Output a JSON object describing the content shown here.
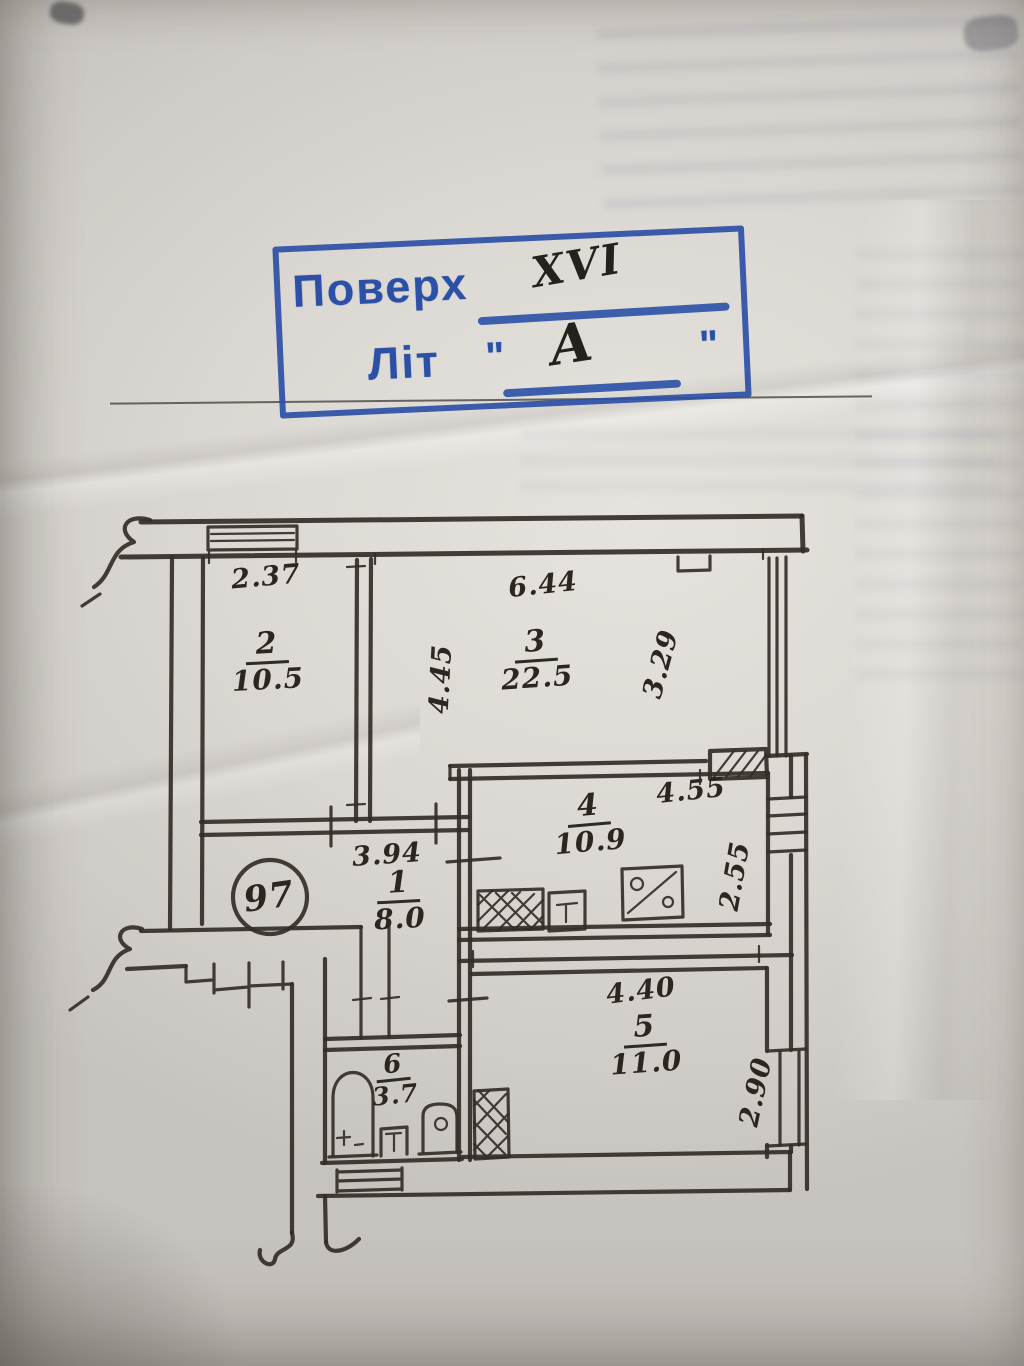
{
  "stamp": {
    "floor_label": "Поверх",
    "floor_value": "XVI",
    "letter_label": "Літ",
    "letter_value": "А",
    "quote_mark": "\"",
    "ink_color": "#2b50a6",
    "handwriting_color": "#25221d"
  },
  "plan": {
    "apartment_number": "97",
    "ink_color": "#332e28",
    "rooms": [
      {
        "number": "1",
        "area": "8.0"
      },
      {
        "number": "2",
        "area": "10.5"
      },
      {
        "number": "3",
        "area": "22.5"
      },
      {
        "number": "4",
        "area": "10.9"
      },
      {
        "number": "5",
        "area": "11.0"
      },
      {
        "number": "6",
        "area": "3.7"
      }
    ],
    "dimensions": {
      "room2_width": "2.37",
      "room2_depth": "4.45",
      "room3_width": "6.44",
      "room3_depth": "3.29",
      "room4_width": "4.55",
      "room4_depth": "2.55",
      "hall_width": "3.94",
      "room5_width": "4.40",
      "room5_depth": "2.90"
    }
  }
}
